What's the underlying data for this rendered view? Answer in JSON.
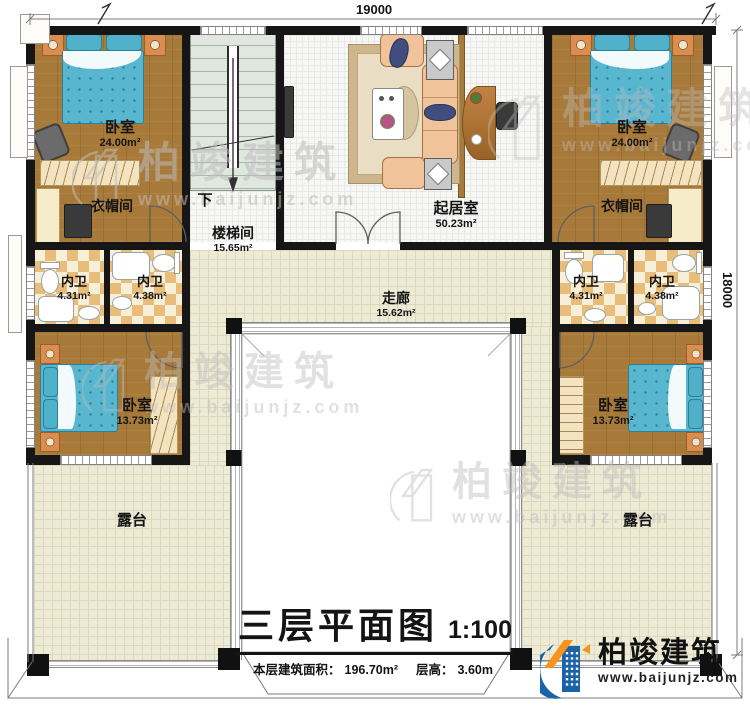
{
  "dimensions": {
    "top": "19000",
    "right": "18000"
  },
  "rooms": {
    "bedroom_top_left": {
      "name": "卧室",
      "area": "24.00m²"
    },
    "closet_left": {
      "name": "衣帽间"
    },
    "stairwell": {
      "name": "楼梯间",
      "area": "15.65m²",
      "direction": "下"
    },
    "living_room": {
      "name": "起居室",
      "area": "50.23m²"
    },
    "bedroom_top_right": {
      "name": "卧室",
      "area": "24.00m²"
    },
    "closet_right": {
      "name": "衣帽间"
    },
    "bathroom_left_outer": {
      "name": "内卫",
      "area": "4.31m²"
    },
    "bathroom_left_inner": {
      "name": "内卫",
      "area": "4.38m²"
    },
    "bathroom_right_inner": {
      "name": "内卫",
      "area": "4.31m²"
    },
    "bathroom_right_outer": {
      "name": "内卫",
      "area": "4.38m²"
    },
    "corridor": {
      "name": "走廊",
      "area": "15.62m²"
    },
    "bedroom_mid_left": {
      "name": "卧室",
      "area": "13.73m²"
    },
    "bedroom_mid_right": {
      "name": "卧室",
      "area": "13.73m²"
    },
    "terrace_left": {
      "name": "露台"
    },
    "terrace_right": {
      "name": "露台"
    }
  },
  "title_block": {
    "title": "三层平面图",
    "scale": "1:100",
    "area_label": "本层建筑面积：",
    "area_value": "196.70m²",
    "height_label": "层高：",
    "height_value": "3.60m"
  },
  "branding": {
    "name": "柏竣建筑",
    "website": "www.baijunjz.com"
  },
  "watermark": {
    "name": "柏竣建筑",
    "website": "www.baijunjz.com"
  },
  "colors": {
    "wall": "#161616",
    "wood_floor": "#a87a39",
    "bed": "#58b6cf",
    "bath_tile": "#e7bd79",
    "paved_floor": "#edead6",
    "stair": "#dfe7df",
    "sofa": "#f0c39b",
    "carpet": "#e9ddc3",
    "logo_blue": "#1b63a8",
    "logo_orange": "#f7941d"
  }
}
